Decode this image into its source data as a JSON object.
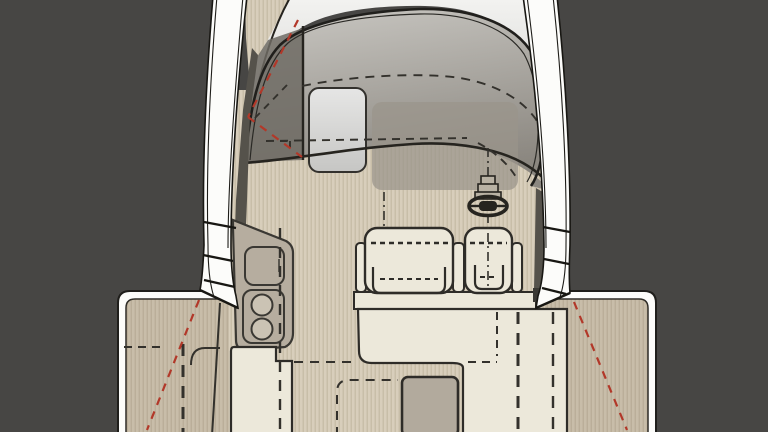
{
  "diagram": {
    "title": "boat-deck-plan-top-view",
    "type": "floor-plan",
    "parts": [
      "hull",
      "port-rail",
      "starboard-rail",
      "port-boarding-gate",
      "starboard-boarding-gate",
      "foredeck-roof",
      "windshield-glass",
      "port-quarter-glass",
      "cabin-door",
      "side-walkway-teak",
      "cockpit-teak-floor",
      "helm-wheel",
      "helm-console",
      "companion-bench-seat",
      "helm-seat",
      "seat-base",
      "galley-unit",
      "galley-sink",
      "galley-burners",
      "aft-cream-cabinet-port",
      "aft-cream-seat-starboard",
      "deck-hatch",
      "swim-platform",
      "terrace-fold-line-port",
      "terrace-fold-line-starboard",
      "door-swing-red-dashes",
      "hardtop-dashed-outline",
      "cabin-dashed-outline",
      "centerline-dash"
    ]
  },
  "colors": {
    "background": "#474644",
    "hull_white": "#fcfcfa",
    "outline": "#22211d",
    "teak": "#d8cebb",
    "teak_stripe": "#c3b8a2",
    "teak_shade": "rgba(90,74,52,0.13)",
    "cream": "#ece8da",
    "cream_stroke": "#2e2c28",
    "galley": "#b6ad9f",
    "appliance": "#cbc3b4",
    "glass_top": "#c9c7c2",
    "glass_bottom": "#8b8780",
    "glass_side": "#6f6b64",
    "console_shadow": "#9a948a",
    "roof_top": "#f3f3f1",
    "roof_bottom": "#c2c1be",
    "door_top": "#e6e6e5",
    "door_bottom": "#c6c6c4",
    "shadow": "#55524b",
    "hatch": "#b2aa9d",
    "dark_block": "#3a3833",
    "dash_dark": "#33312c",
    "red_dashed": "#b23829"
  }
}
